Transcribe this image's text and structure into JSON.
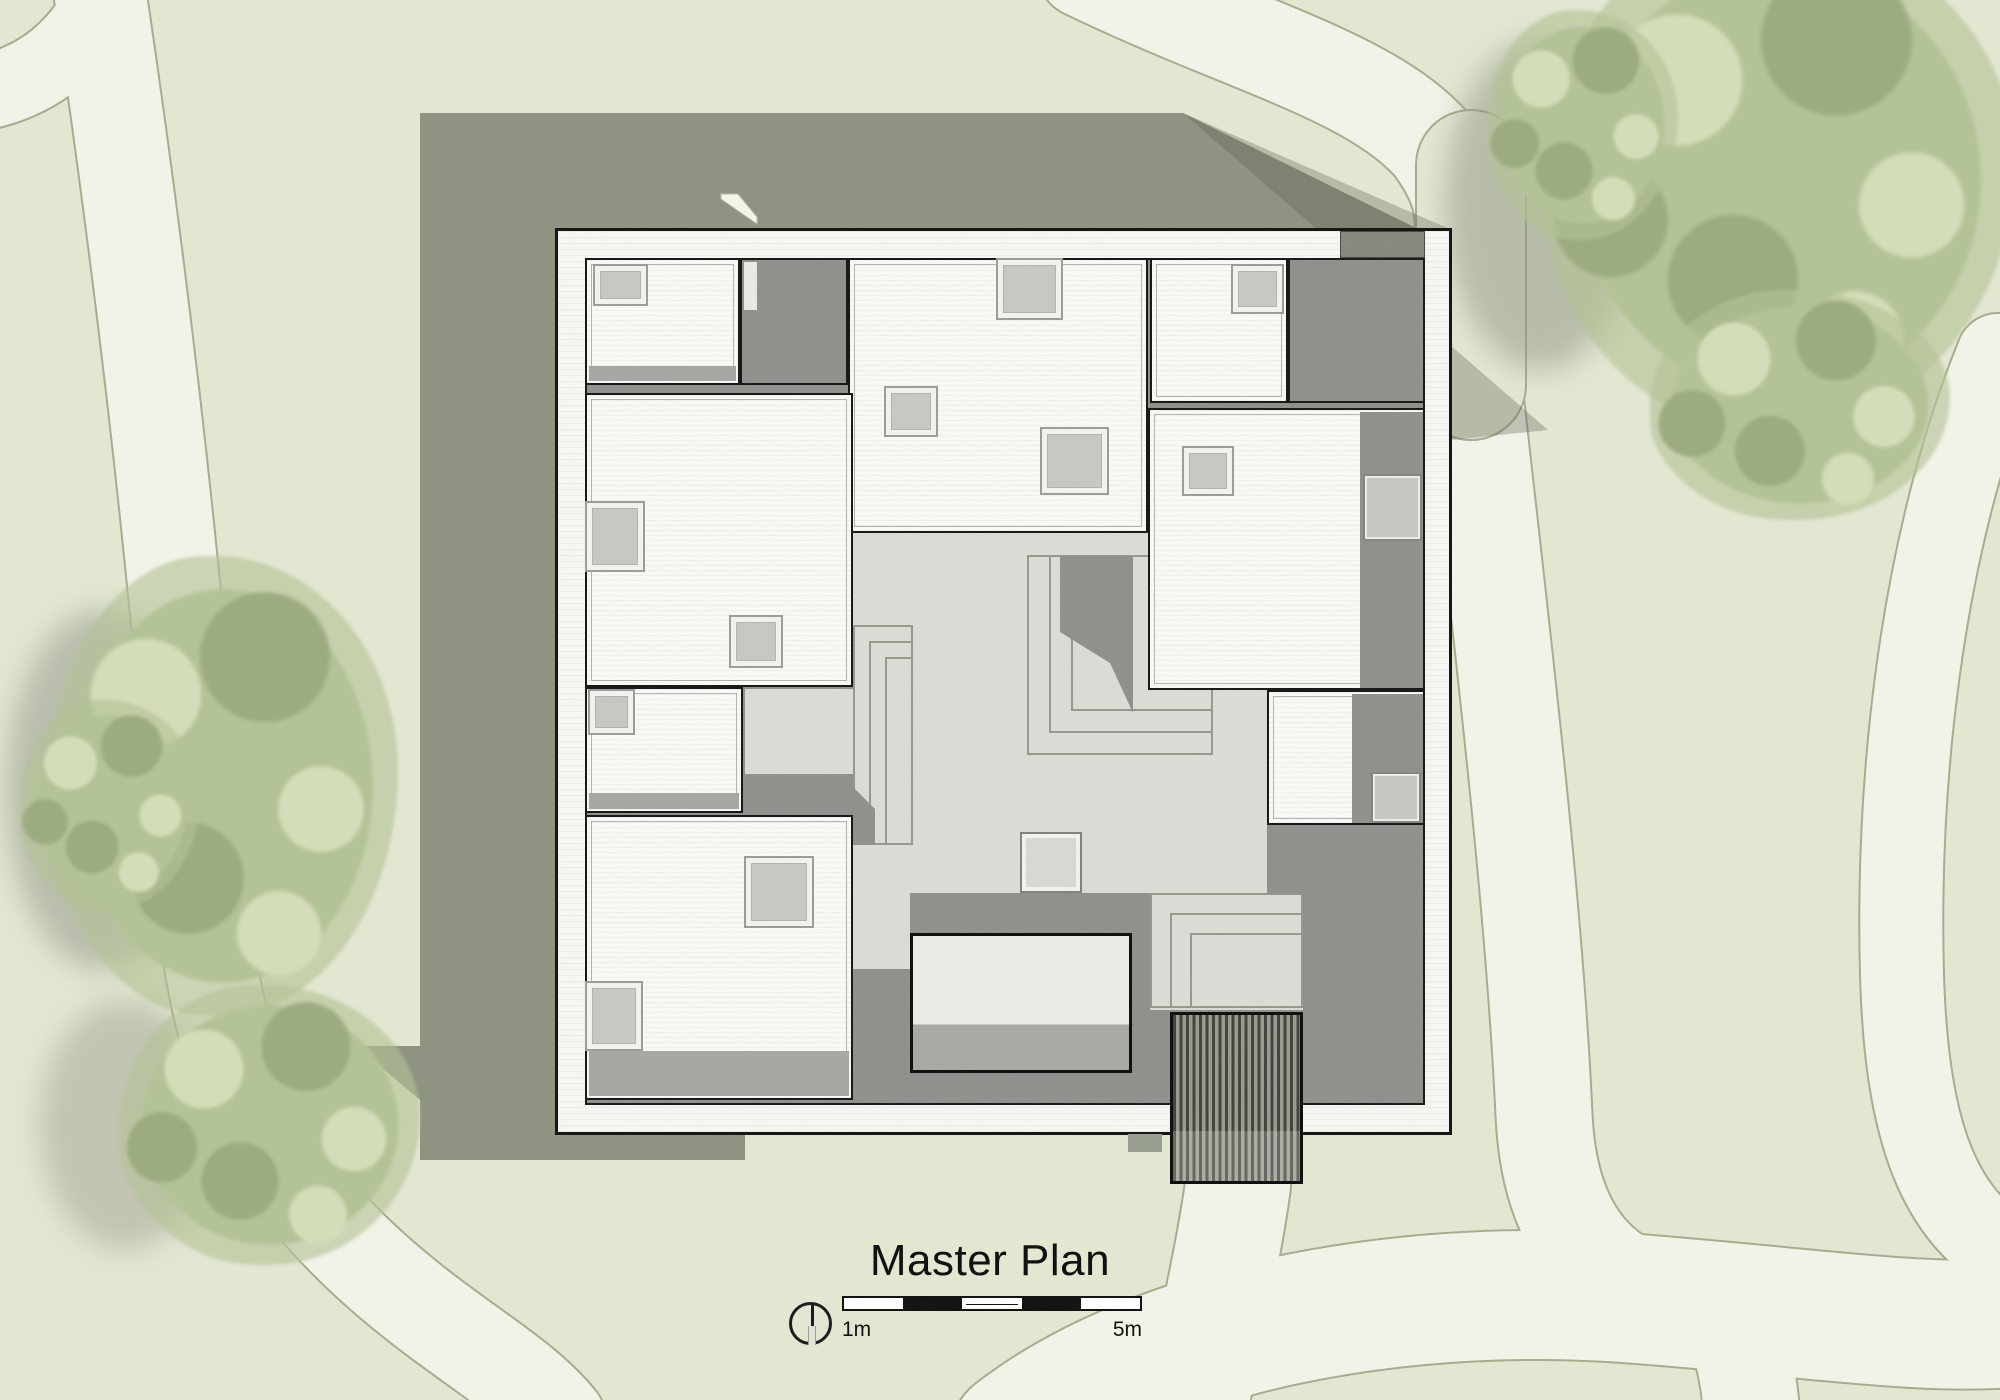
{
  "title_block": {
    "title": "Master Plan",
    "north_arrow_icon": "north-indicator-icon",
    "scale_bar": {
      "start_label": "1m",
      "end_label": "5m",
      "segments": [
        "#ffffff",
        "#141414",
        "#ffffff",
        "#141414",
        "#ffffff"
      ]
    }
  },
  "palette": {
    "grass": "#e3e7d2",
    "path": "#f2f3e8",
    "path_edge": "#a8ac8e",
    "canopy": "#b4c297",
    "canopy_light": "#d4ddb9",
    "canopy_dark": "#9dab81",
    "building_shadow": "rgba(91,97,79,0.62)",
    "wall_white": "#f5f5f2",
    "roof_white": "#f8f8f5",
    "courtyard_light": "#dbdbd6",
    "courtyard_dark": "#8f918c",
    "skylight_gray": "#c7c7c4",
    "ink": "#161616"
  }
}
